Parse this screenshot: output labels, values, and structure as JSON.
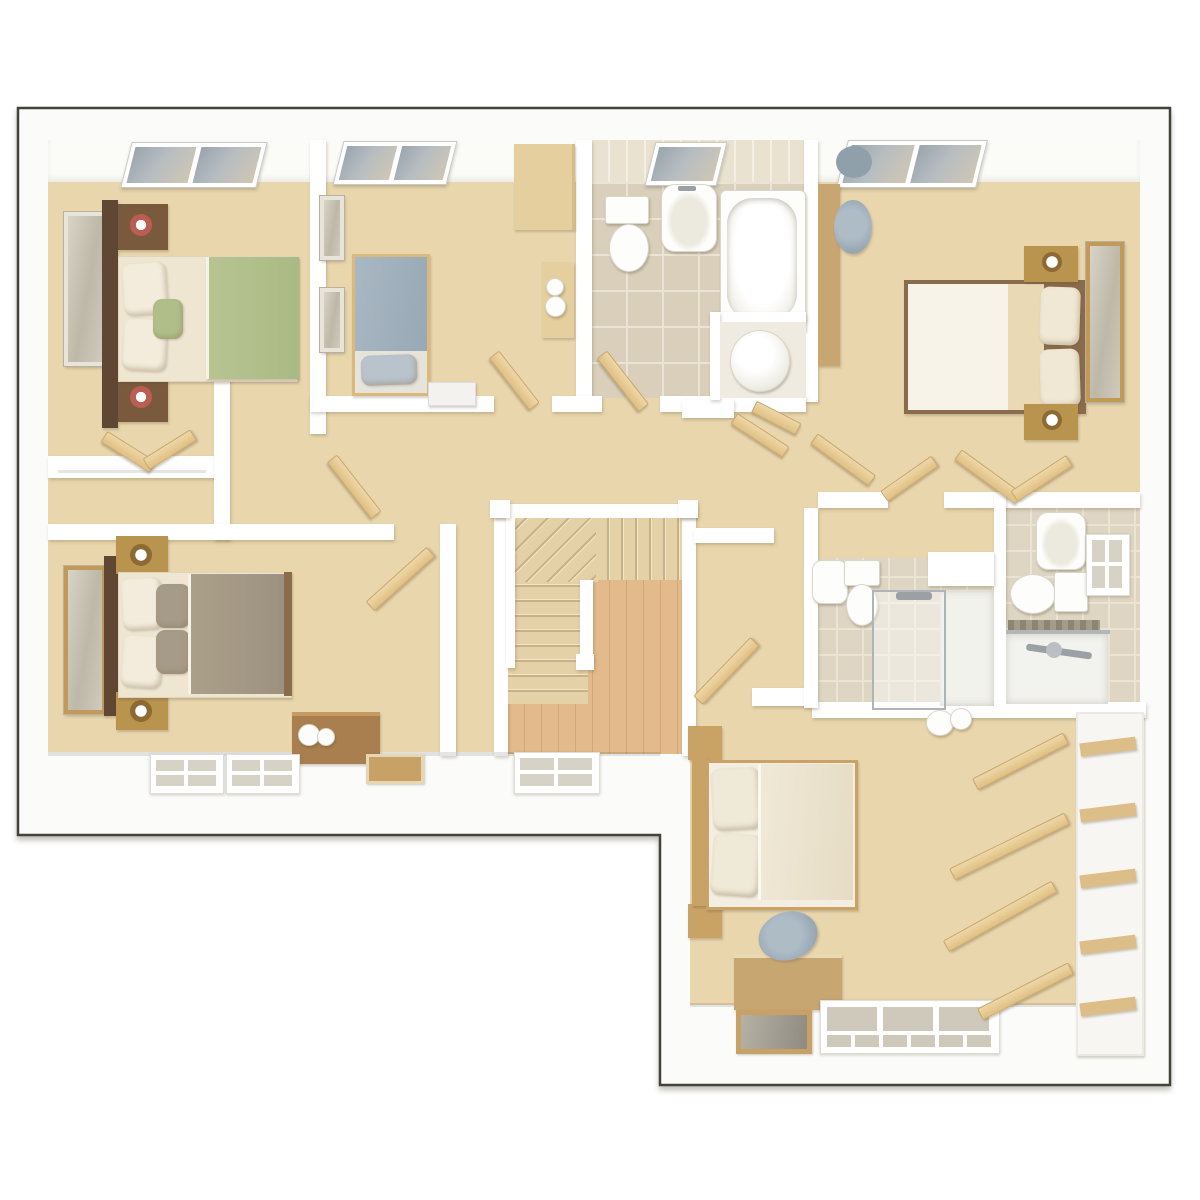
{
  "scene": {
    "type": "3d-floor-plan-render",
    "view": "top-down dollhouse",
    "text_visible": false
  },
  "palette": {
    "outline": "#44433b",
    "shell_white": "#fbfbf9",
    "wall_white": "#ffffff",
    "carpet": "#e9d6ad",
    "tile_floor": "#d9cfba",
    "tile_grout": "#ebe4d4",
    "tile_wall": "#eae2d0",
    "tile_wall_line": "#f4efe3",
    "shower_tile": "#ded6c3",
    "wood_floor": "#e2ba8c",
    "wood_plank": "#d2a878",
    "stair_step": "#e4d1a7",
    "stair_edge": "#f1e5c8",
    "stair_shadow": "#c9b187",
    "door_wood": "#eed7a7",
    "door_edge": "#c9a86c",
    "walnut": "#5f4733",
    "walnut2": "#7a5a3c",
    "mid_wood": "#c8a671",
    "gold_wood": "#b8944f",
    "light_wood": "#e6cf9e",
    "chest_wood": "#a97f4f",
    "bed5_wood": "#c9a266",
    "green": "#b7c492",
    "blue": "#a9b8c3",
    "taupe": "#aba089",
    "pillow_grey": "#a69b89",
    "cream": "#f3ecdc",
    "cream_soft": "#ead9b5",
    "mattress": "#f7f3e8",
    "chair_grey": "#97a7b2",
    "glass": "#9aa5ad",
    "glass_light": "#cfc6b4",
    "mirror_glass": "#cfcabb",
    "fixture": "#fdfdfb",
    "fixture_edge": "#d9d6cc",
    "chrome": "#9aa0a4"
  },
  "rooms": [
    {
      "id": "bedroom-1",
      "label": "bedroom top-left with double bed, green duvet, skylight"
    },
    {
      "id": "bedroom-2",
      "label": "single bedroom top-middle with blue bed, wardrobe, skylight"
    },
    {
      "id": "family-bathroom",
      "label": "bathroom with toilet, basin, bath, airing cupboard"
    },
    {
      "id": "bedroom-3",
      "label": "master bedroom top-right with desk, chair, dressing area, skylight"
    },
    {
      "id": "bedroom-4",
      "label": "bedroom mid-left with double bed, taupe duvet, chest"
    },
    {
      "id": "walk-in-wardrobe",
      "label": "closet with rail between bedroom 1 and bedroom 4"
    },
    {
      "id": "landing",
      "label": "central landing and corridors"
    },
    {
      "id": "staircase",
      "label": "winder staircase with white balustrade over wood floor"
    },
    {
      "id": "shower-room-1",
      "label": "en-suite with basin, toilet, glazed shower"
    },
    {
      "id": "shower-room-2",
      "label": "en-suite with basin, toilet, shower bar, window"
    },
    {
      "id": "bedroom-5",
      "label": "lower-right bedroom with double bed, desk, open wardrobes"
    }
  ],
  "furniture": {
    "bedroom_1": [
      "mirror",
      "headboard",
      "2 nightstands with red lamps",
      "double bed",
      "green duvet",
      "pillows",
      "skylight"
    ],
    "bedroom_2": [
      "2 wall pictures",
      "single bed blue duvet",
      "white drawer unit",
      "tall wardrobe",
      "desk with vases",
      "skylight"
    ],
    "family_bathroom": [
      "toilet",
      "pedestal basin",
      "bathtub",
      "hot water cylinder",
      "skylight",
      "door"
    ],
    "bedroom_3": [
      "desk",
      "2 grey chairs",
      "double bed cream bedding",
      "2 nightstands with lamps",
      "mirror",
      "4 open wardrobe doors",
      "skylight"
    ],
    "bedroom_4": [
      "mirror",
      "headboard",
      "2 nightstands with gold lamps",
      "double bed taupe duvet",
      "wooden chest with spheres",
      "2 windows",
      "floor frame"
    ],
    "staircase": [
      "handrail",
      "newel posts",
      "upper flight",
      "winder treads",
      "lower flight",
      "window"
    ],
    "shower_room_1": [
      "basin",
      "toilet",
      "glazed shower enclosure",
      "shower head",
      "half wall"
    ],
    "shower_room_2": [
      "basin",
      "toilet",
      "window",
      "shower tray",
      "chrome mixer bar",
      "mosaic strip"
    ],
    "bedroom_5": [
      "double bed cream bedding",
      "headboard",
      "2 nightstands",
      "desk",
      "grey chair",
      "floor frame",
      "triple window",
      "4 open wardrobe doors",
      "shelving unit",
      "2 baskets"
    ]
  }
}
